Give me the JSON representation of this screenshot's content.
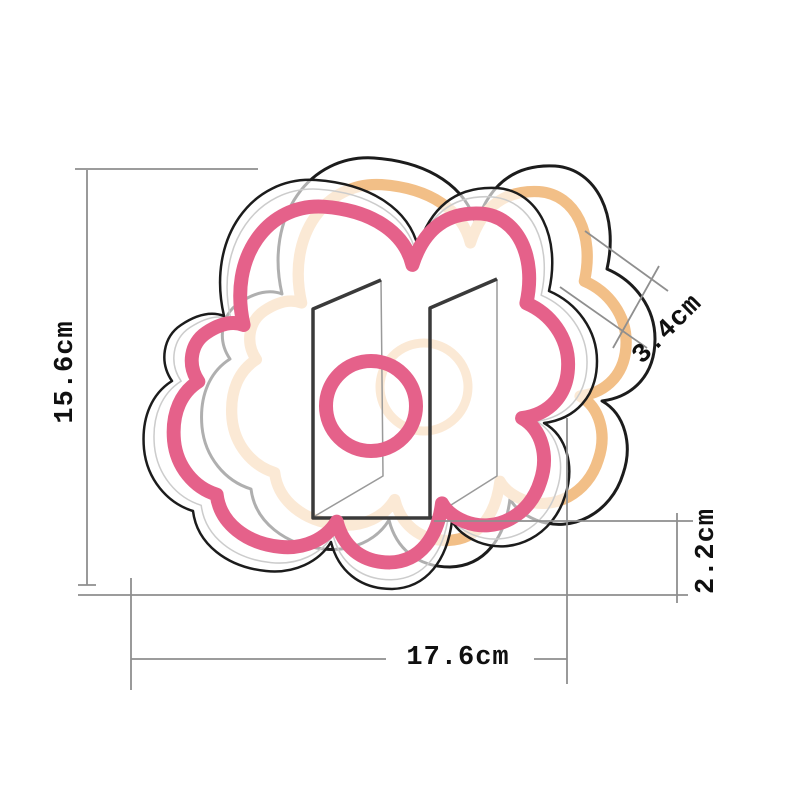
{
  "diagram": {
    "kind": "product-dimension-diagram",
    "subject": "cloud-shaped neon light sign with acrylic panels, inner ring and stand",
    "dimensions": {
      "height": {
        "label": "15.6cm",
        "value": 15.6,
        "unit": "cm",
        "placement": "left-vertical"
      },
      "width": {
        "label": "17.6cm",
        "value": 17.6,
        "unit": "cm",
        "placement": "bottom-horizontal"
      },
      "depth": {
        "label": "3.4cm",
        "value": 3.4,
        "unit": "cm",
        "placement": "top-right-diagonal"
      },
      "base": {
        "label": "2.2cm",
        "value": 2.2,
        "unit": "cm",
        "placement": "right-vertical"
      }
    }
  },
  "colors": {
    "bg": "#ffffff",
    "pink": "#e5618a",
    "orange": "#f2bf87",
    "outline": "#1c1c1c",
    "panel": "#3a3a3a",
    "panelfaint": "#9a9a9a",
    "dimline": "#8f8f8f",
    "faint": "#cccccc",
    "label": "#101010"
  }
}
